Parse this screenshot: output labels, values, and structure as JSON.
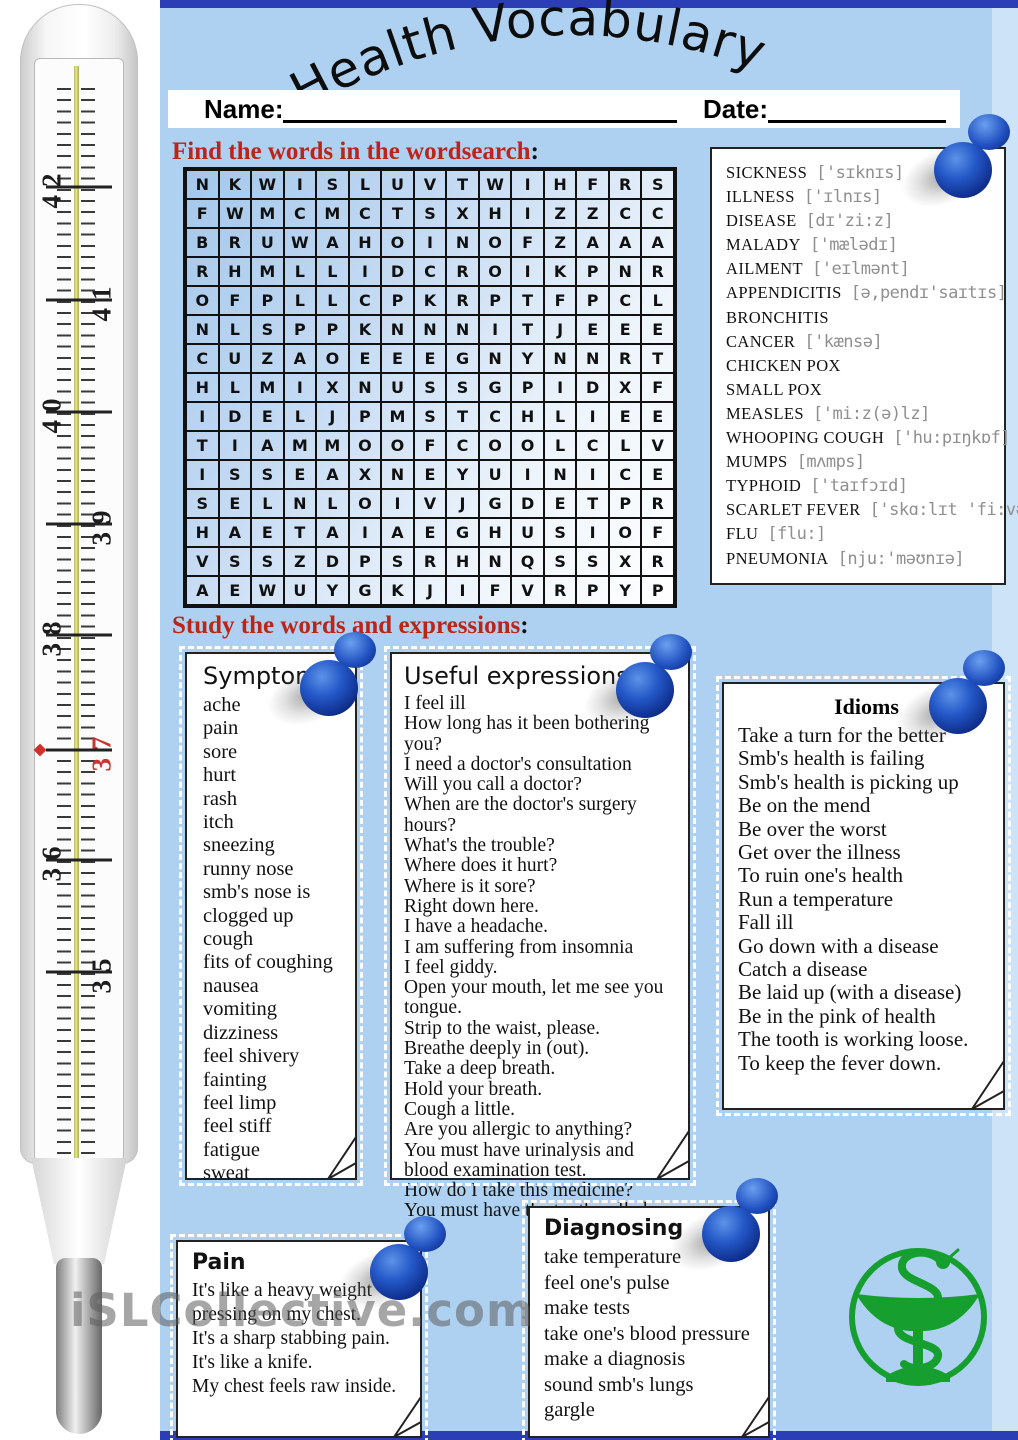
{
  "title": "Health Vocabulary",
  "form": {
    "name_label": "Name:",
    "date_label": "Date:"
  },
  "sections": {
    "wordsearch_heading": "Find the words in the wordsearch",
    "study_heading": "Study the words and expressions",
    "colon": ":"
  },
  "wordsearch": {
    "rows": [
      "NKWISLUVTWIHFRS",
      "FWMCMCTSXHIZZCC",
      "BRUWAHOINOFZAAA",
      "RHMLLIDCROIKPNR",
      "OFPLLCPKRPTFPCL",
      "NLSPPKNNNITJEEE",
      "CUZAOEEEGNYNNRT",
      "HLMIXNUSSGPIDXF",
      "IDELJPMSTCHLIEE",
      "TIAMMOOFCOOLCLV",
      "ISSEAXNEYUINICE",
      "SELNLOIVJGDETPR",
      "HAETAIAEGHUSIOF",
      "VSSZDPSRHNQSSXR",
      "AEWUYGKJIFVRPYP"
    ]
  },
  "vocabulary": [
    {
      "word": "SICKNESS",
      "phon": "['sɪknɪs]"
    },
    {
      "word": "ILLNESS",
      "phon": "['ɪlnɪs]"
    },
    {
      "word": "DISEASE",
      "phon": "[dɪ'zi:z]"
    },
    {
      "word": "MALADY",
      "phon": "['mælədɪ]"
    },
    {
      "word": "AILMENT",
      "phon": "['eɪlmənt]"
    },
    {
      "word": "APPENDICITIS",
      "phon": "[ə,pendɪ'saɪtɪs]"
    },
    {
      "word": "BRONCHITIS",
      "phon": ""
    },
    {
      "word": "CANCER",
      "phon": "['kænsə]"
    },
    {
      "word": "CHICKEN POX",
      "phon": ""
    },
    {
      "word": "SMALL POX",
      "phon": ""
    },
    {
      "word": "MEASLES",
      "phon": "['mi:z(ə)lz]"
    },
    {
      "word": "WHOOPING COUGH",
      "phon": "['hu:pɪŋkɒf]"
    },
    {
      "word": "MUMPS",
      "phon": "[mʌmps]"
    },
    {
      "word": "TYPHOID",
      "phon": "['taɪfɔɪd]"
    },
    {
      "word": "SCARLET FEVER",
      "phon": "['skɑ:lɪt 'fi:və]"
    },
    {
      "word": "FLU",
      "phon": "[flu:]"
    },
    {
      "word": "PNEUMONIA",
      "phon": "[nju:'məʊnɪə]"
    }
  ],
  "cards": {
    "symptoms": {
      "title": "Symptoms",
      "items": [
        "ache",
        "pain",
        "sore",
        "hurt",
        "rash",
        "itch",
        "sneezing",
        "runny nose",
        "smb's nose is",
        "clogged up",
        "cough",
        "fits of coughing",
        "nausea",
        "vomiting",
        "dizziness",
        "feel shivery",
        "fainting",
        "feel limp",
        "feel stiff",
        "fatigue",
        "sweat"
      ]
    },
    "expressions": {
      "title": "Useful expressions",
      "items": [
        "I feel ill",
        "How long has it been bothering you?",
        "I need a doctor's consultation",
        "Will you call a doctor?",
        "When are the doctor's surgery hours?",
        "What's the trouble?",
        "Where does it hurt?",
        "Where is it sore?",
        "Right down here.",
        "I have a headache.",
        "I am suffering from insomnia",
        "I feel giddy.",
        "Open your mouth, let me see you tongue.",
        "Strip to the waist, please.",
        "Breathe deeply in (out).",
        "Take a deep breath.",
        "Hold your breath.",
        "Cough a little.",
        "Are you allergic to anything?",
        "You must have urinalysis and blood examination test.",
        "How do I take this medicine?",
        "You must have the tooth pulled out."
      ]
    },
    "idioms": {
      "title": "Idioms",
      "items": [
        "Take a turn for the better",
        "Smb's health is failing",
        "Smb's health is picking up",
        "Be on the mend",
        "Be over the worst",
        "Get over the illness",
        "To ruin one's health",
        "Run a temperature",
        "Fall ill",
        "Go down with a disease",
        "Catch a disease",
        "Be laid up (with a disease)",
        "Be in the pink of health",
        "The tooth is working loose.",
        "To keep the fever down."
      ]
    },
    "pain": {
      "title": "Pain",
      "items": [
        "It's like a heavy weight pressing on my chest.",
        "It's a sharp stabbing pain.",
        "It's like a knife.",
        "My chest feels raw inside."
      ]
    },
    "diagnosing": {
      "title": "Diagnosing",
      "items": [
        "take temperature",
        "feel one's pulse",
        "make tests",
        "take one's blood pressure",
        "make a diagnosis",
        "sound smb's lungs",
        "gargle"
      ]
    }
  },
  "thermometer": {
    "marks": [
      {
        "label": "42",
        "side": "left",
        "y": 187,
        "red": false
      },
      {
        "label": "41",
        "side": "right",
        "y": 300,
        "red": false
      },
      {
        "label": "40",
        "side": "left",
        "y": 412,
        "red": false
      },
      {
        "label": "39",
        "side": "right",
        "y": 524,
        "red": false
      },
      {
        "label": "38",
        "side": "left",
        "y": 635,
        "red": false
      },
      {
        "label": "37",
        "side": "right",
        "y": 750,
        "red": true
      },
      {
        "label": "36",
        "side": "left",
        "y": 860,
        "red": false
      },
      {
        "label": "35",
        "side": "right",
        "y": 972,
        "red": false
      }
    ]
  },
  "watermark": "iSLCollective.com",
  "icons": {
    "pushpin": "blue pushpin",
    "pharmacy": "bowl of Hygieia (snake and cup)",
    "page_curl": "page corner curl"
  },
  "colors": {
    "page_blue": "#aed1f1",
    "bar_blue": "#2b3eb5",
    "heading_red": "#bb2418",
    "pin_blue": "#1746b0",
    "pharmacy_green": "#169f2f",
    "mercury_yellow": "#d8d86a",
    "fever_red": "#cc3430"
  }
}
